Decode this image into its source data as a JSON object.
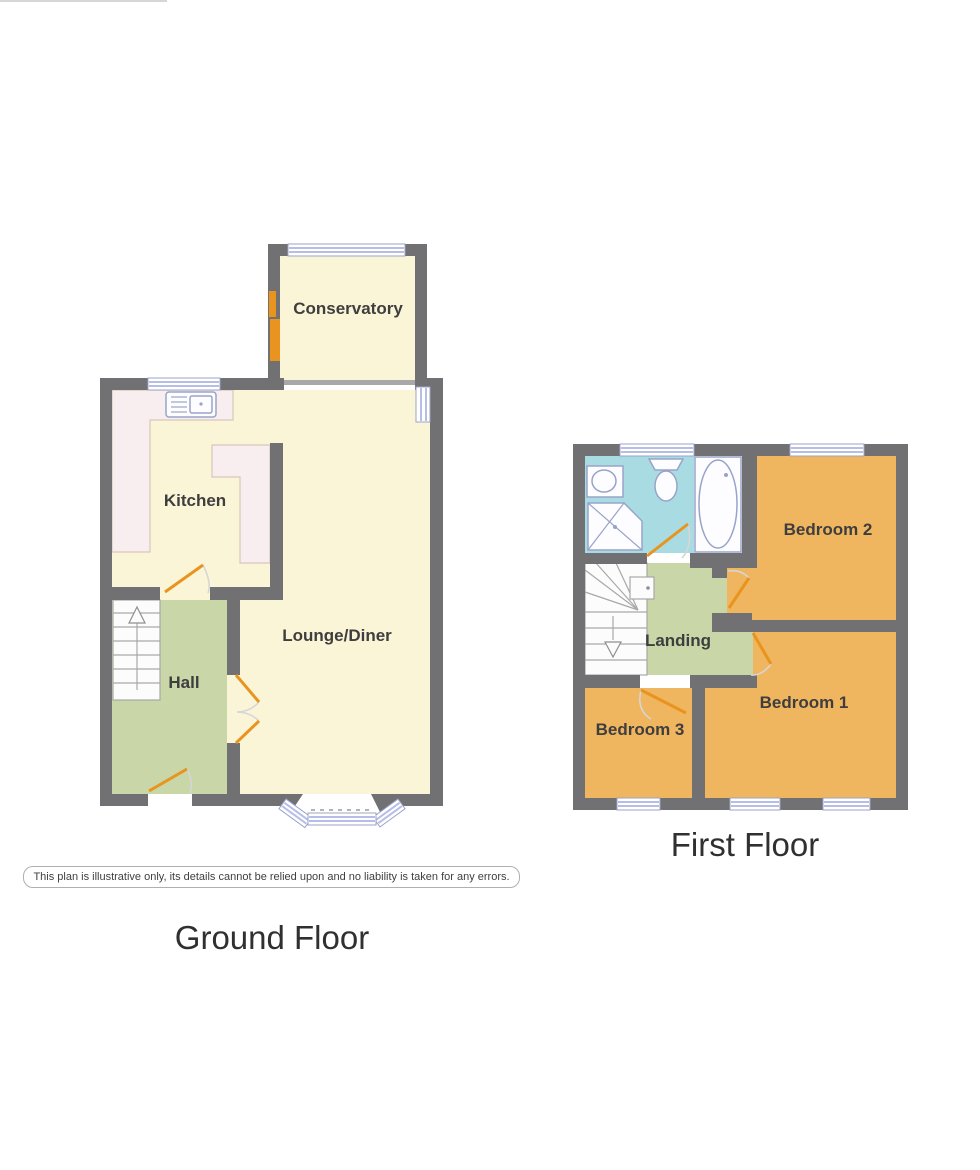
{
  "ground_floor": {
    "title": "Ground Floor",
    "rooms": {
      "conservatory": "Conservatory",
      "kitchen": "Kitchen",
      "lounge": "Lounge/Diner",
      "hall": "Hall"
    }
  },
  "first_floor": {
    "title": "First Floor",
    "rooms": {
      "bedroom1": "Bedroom 1",
      "bedroom2": "Bedroom 2",
      "bedroom3": "Bedroom 3",
      "landing": "Landing"
    },
    "fixtures": [
      "sink",
      "toilet",
      "shower",
      "bath"
    ]
  },
  "disclaimer": "This plan is illustrative only, its details cannot be relied upon and no liability is taken for any errors.",
  "colors": {
    "wall": "#717173",
    "floor_yellow": "#fbf5d8",
    "counter_pink": "#f8eef0",
    "hall_green": "#c9d6a7",
    "bedroom_orange": "#f0b55f",
    "bathroom_blue": "#a9dce2",
    "door_orange": "#e8941f",
    "window_blue": "#b6bde8"
  }
}
